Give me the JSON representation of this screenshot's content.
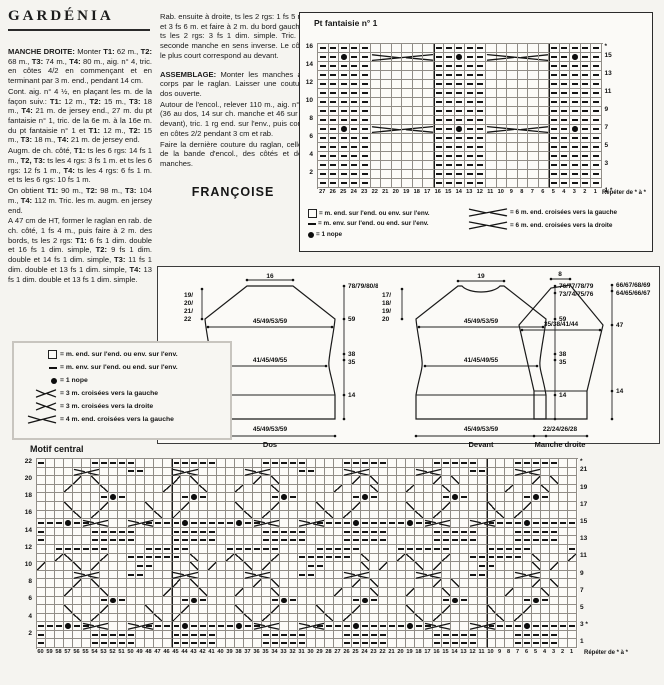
{
  "article": {
    "title": "GARDÉNIA",
    "paragraphs": [
      "<b>MANCHE DROITE:</b> Monter <b>T1:</b> 62 m., <b>T2:</b> 68 m., <b>T3:</b> 74 m., <b>T4:</b> 80 m., aig. n° 4, tric. en côtes 4/2 en commençant et en terminant par 3 m. end., pendant 14 cm.",
      "Cont. aig. n° 4 ½, en plaçant les m. de la façon suiv.: <b>T1:</b> 12 m., <b>T2:</b> 15 m., <b>T3:</b> 18 m., <b>T4:</b> 21 m. de jersey end., 27 m. du pt fantaisie n° 1, tric. de la 6e m. à la 16e m. du pt fantaisie n° 1 et <b>T1:</b> 12 m., <b>T2:</b> 15 m., <b>T3:</b> 18 m., <b>T4:</b> 21 m. de jersey end.",
      "Augm. de ch. côté, <b>T1:</b> ts les 6 rgs: 14 fs 1 m., <b>T2, T3:</b> ts les 4 rgs: 3 fs 1 m. et ts les 6 rgs: 12 fs 1 m., <b>T4:</b> ts les 4 rgs: 6 fs 1 m. et ts les 6 rgs: 10 fs 1 m.",
      "On obtient <b>T1:</b> 90 m., <b>T2:</b> 98 m., <b>T3:</b> 104 m., <b>T4:</b> 112 m. Tric. les m. augm. en jersey end.",
      "A 47 cm de HT, former le raglan en rab. de ch. côté, 1 fs 4 m., puis faire à 2 m. des bords, ts les 2 rgs: <b>T1:</b> 6 fs 1 dim. double et 16 fs 1 dim. simple, <b>T2:</b> 9 fs 1 dim. double et 14 fs 1 dim. simple, <b>T3:</b> 11 fs 1 dim. double et 13 fs 1 dim. simple, <b>T4:</b> 13 fs 1 dim. double et 13 fs 1 dim. simple."
    ]
  },
  "col2": {
    "paragraphs": [
      "Rab. ensuite à droite, ts les 2 rgs: 1 fs 5 m. et 3 fs 6 m. et faire à 2 m. du bord gauche, ts les 2 rgs: 3 fs 1 dim. simple. Tric. la seconde manche en sens inverse. Le côté le plus court correspond au devant.",
      "<b>ASSEMBLAGE:</b> Monter les manches au corps par le raglan. Laisser une couture dos ouverte.",
      "Autour de l'encol., relever 110 m., aig. n° 4 (36 au dos, 14 sur ch. manche et 46 sur le devant), tric. 1 rg end. sur l'env., puis cont. en côtes 2/2 pendant 3 cm et rab.",
      "Faire la dernière couture du raglan, celles de la bande d'encol., des côtés et des manches."
    ],
    "signature": "FRANÇOISE"
  },
  "chart1": {
    "title": "Pt fantaisie n° 1",
    "rows": [
      "-----......-----......-----",
      "--o--(.....--o--).....--o--",
      "-----......-----......-----",
      "-----......-----......-----",
      "-----......-----......-----",
      "-----......-----......-----",
      "-----......-----......-----",
      "-----......-----......-----",
      "-----......-----......-----",
      "--o--(.....--o--).....--o--",
      "-----......-----......-----",
      "-----......-----......-----",
      "-----......-----......-----",
      "-----......-----......-----",
      "-----......-----......-----",
      "-----......-----......-----"
    ],
    "left_labels": [
      "16",
      "",
      "14",
      "",
      "12",
      "",
      "10",
      "",
      "8",
      "",
      "6",
      "",
      "4",
      "",
      "2",
      ""
    ],
    "right_labels": [
      "*",
      "15",
      "",
      "13",
      "",
      "11",
      "",
      "9",
      "",
      "7",
      "",
      "5",
      "",
      "3",
      "",
      "",
      "1 *"
    ],
    "col_numbers": [
      "27",
      "26",
      "25",
      "24",
      "23",
      "22",
      "21",
      "20",
      "19",
      "18",
      "17",
      "16",
      "15",
      "14",
      "13",
      "12",
      "11",
      "10",
      "9",
      "8",
      "7",
      "6",
      "5",
      "4",
      "3",
      "2",
      "1"
    ],
    "repeat_label": "Répéter de * à *",
    "legend_left": [
      {
        "glyph": "square",
        "text": "= m. end. sur l'end. ou env. sur l'env."
      },
      {
        "glyph": "dash",
        "text": "= m. env. sur l'end. ou end. sur l'env."
      },
      {
        "glyph": "dot",
        "text": "= 1 nope"
      }
    ],
    "legend_right": [
      {
        "glyph": "cable6l",
        "text": "= 6 m. end. croisées vers la gauche"
      },
      {
        "glyph": "cable6r",
        "text": "= 6 m. end. croisées vers la droite"
      }
    ]
  },
  "legend2": {
    "items": [
      {
        "glyph": "square",
        "text": "= m. end. sur l'end. ou env. sur l'env."
      },
      {
        "glyph": "dash",
        "text": "= m. env. sur l'end. ou end. sur l'env."
      },
      {
        "glyph": "dot",
        "text": "= 1 nope"
      },
      {
        "glyph": "cross3l",
        "text": "= 3 m. croisées vers la gauche"
      },
      {
        "glyph": "cross3r",
        "text": "= 3 m. croisées vers la droite"
      },
      {
        "glyph": "cross4l",
        "text": "= 4 m. end. croisées vers la gauche"
      }
    ]
  },
  "schematics": {
    "dos": {
      "top": "16",
      "raglan": [
        "19/",
        "20/",
        "21/",
        "22"
      ],
      "upper_width": "45/49/53/59",
      "waist_width": "41/45/49/55",
      "bottom_width": "45/49/53/59",
      "h_total": "78/79/80/81",
      "h_underarm": "59",
      "h_38": "38",
      "h_35": "35",
      "h_rib": "14",
      "caption": "Dos"
    },
    "devant": {
      "top": "19",
      "raglan": [
        "17/",
        "18/",
        "19/",
        "20"
      ],
      "upper_width": "45/49/53/59",
      "waist_width": "41/45/49/55",
      "bottom_width": "45/49/53/59",
      "h_total": "76/77/78/79",
      "h_neck": "73/74/75/76",
      "h_underarm": "59",
      "h_38": "38",
      "h_35": "35",
      "h_rib": "14",
      "caption": "Devant"
    },
    "manche": {
      "top": "8",
      "mid_width": "35/38/41/44",
      "bottom_width": "22/24/26/28",
      "h_total": "66/67/68/69",
      "h_2": "64/65/66/67",
      "h_underarm": "47",
      "h_rib": "14",
      "caption": "Manche droite"
    }
  },
  "chart2": {
    "title": "Motif central",
    "rows": [
      "-.....-----....-----.....-----....-----.....-----....-----..",
      ".....X....--....X.......X....--....X.......X....--....X.....",
      "....\\./........\\./......\\./........\\./......\\./........\\./....",
      "...\\.../......\\.../...\\.../......\\.../...\\.../......\\.../...",
      ".......-o-......-o-.......-o-......-o-.......-o-......-o-...",
      ".../...\\..../...\\...../...\\..../...\\...../...\\..../...\\.....",
      "..../.\\....../.\\......./.\\....../.\\......./.\\....../.\\......",
      "---o--X....X----o-----o--X....X----o-----o--X....X----o-----",
      "-.....-----....-----.....-----....-----.....-----....-----..",
      "-.....-----....-----.....-----....-----.....-----....-----..",
      "..------....-----....------....-----....------....-----....-",
      "..\\/...\\..------./...\\/...\\..------./...\\/...\\..------./...\\",
      "\\.../.\\....--..../.\\.../.\\....--..../.\\.../.\\....--..../.\\..",
      ".....X....--....X.......X....--....X.......X....--....X.....",
      "....\\./........\\./......\\./........\\./......\\./........\\./....",
      "...\\.../......\\.../...\\.../......\\.../...\\.../......\\.../...",
      ".......-o-......-o-.......-o-......-o-.......-o-......-o-...",
      ".../...\\..../...\\...../...\\..../...\\...../...\\..../...\\.....",
      "..../.\\....../.\\......./.\\....../.\\......./.\\....../.\\......",
      "---o--X....X----o-----o--X....X----o-----o--X....X----o-----",
      "-.....-----....-----.....-----....-----.....-----....-----..",
      "-.....-----....-----.....-----....-----.....-----....-----.."
    ],
    "left_labels": [
      "22",
      "",
      "20",
      "",
      "18",
      "",
      "16",
      "",
      "14",
      "",
      "12",
      "",
      "10",
      "",
      "8",
      "",
      "6",
      "",
      "4",
      "",
      "2",
      ""
    ],
    "right_labels": [
      "*",
      "21",
      "",
      "19",
      "",
      "17",
      "",
      "15",
      "",
      "13",
      "",
      "11",
      "",
      "9",
      "",
      "7",
      "",
      "5",
      "",
      "3 *",
      "",
      "1"
    ],
    "col_numbers": [
      "60",
      "59",
      "58",
      "57",
      "56",
      "55",
      "54",
      "53",
      "52",
      "51",
      "50",
      "49",
      "48",
      "47",
      "46",
      "45",
      "44",
      "43",
      "42",
      "41",
      "40",
      "39",
      "38",
      "37",
      "36",
      "35",
      "34",
      "33",
      "32",
      "31",
      "30",
      "29",
      "28",
      "27",
      "26",
      "25",
      "24",
      "23",
      "22",
      "21",
      "20",
      "19",
      "18",
      "17",
      "16",
      "15",
      "14",
      "13",
      "12",
      "11",
      "10",
      "9",
      "8",
      "7",
      "6",
      "5",
      "4",
      "3",
      "2",
      "1"
    ],
    "repeat_label": "Répéter de * à *"
  }
}
